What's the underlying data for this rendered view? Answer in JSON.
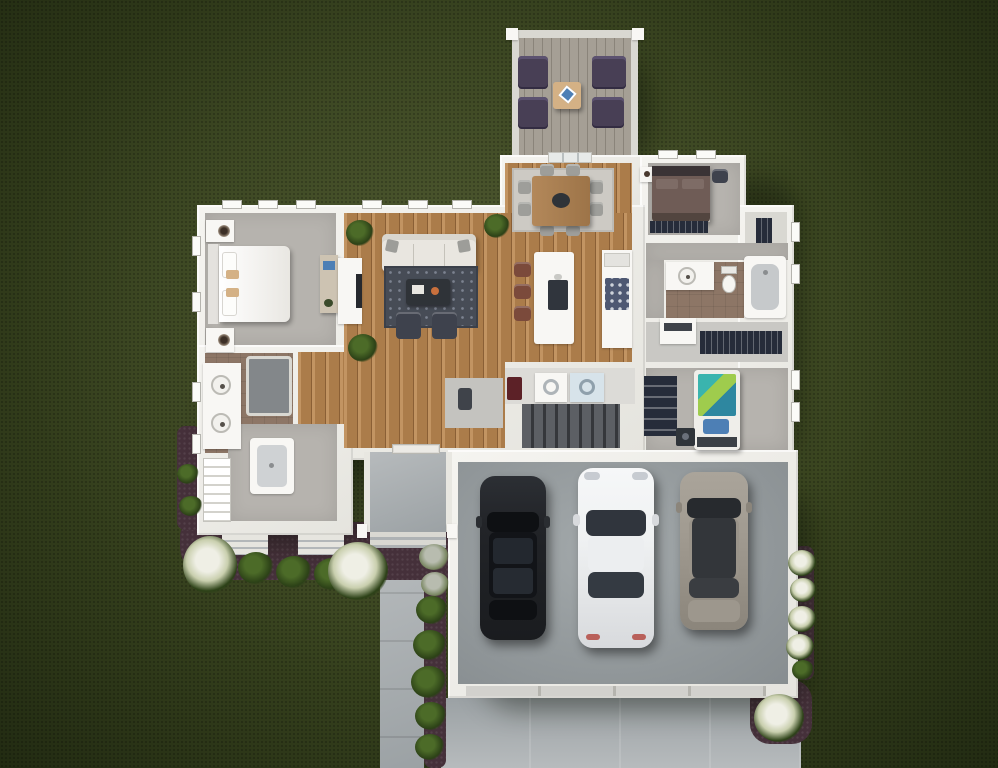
{
  "title": "Aerial 3D floor plan rendering of a single-story home with three-car garage and rear deck",
  "palette": {
    "grassHi": "#4b5629",
    "grassMid": "#39441f",
    "grassLo": "#222b12",
    "mulch": "#45303a",
    "wall": "#f2f1ed",
    "wallShade": "#d9d8d2",
    "wallDk": "#bcbbb5",
    "carpet": "#b6b3ae",
    "carpetDk": "#a5a29d",
    "woodHi": "#c29462",
    "wood": "#ab7c4a",
    "woodLo": "#8a5f35",
    "rugDining": "#cdcac4",
    "rugLiving": "#474c56",
    "rugDot": "#7c8290",
    "tile": "#8d7666",
    "concrete": "#b7bbbd",
    "concreteDk": "#9ba1a4",
    "garageHi": "#a3a9ab",
    "garageLo": "#878d90",
    "deckWood": "#a59f95",
    "deckGap": "#8a847a",
    "stairTread": "#5c5f64",
    "stairGap": "#35373b",
    "navy": "#262c3a",
    "sofa": "#e9e6e0",
    "pillowGray": "#9d9d99",
    "white": "#f8f7f4",
    "tan": "#d4b185",
    "chairDk": "#3e424d",
    "purple": "#483f55",
    "purpleHi": "#5c5270",
    "tableWood": "#b3885a",
    "tableDk": "#2f3338",
    "chairGray": "#9e9e9a",
    "stool": "#7b4a3b",
    "cooktop": "#4e5872",
    "appliance": "#d7e3ea",
    "hamper": "#5c2127",
    "bedBrown": "#6f5c56",
    "bedBrownDk": "#52453f",
    "headboardDk": "#3a3335",
    "teal": "#3ab4ae",
    "lime": "#9fcc4d",
    "tealDk": "#2e87a0",
    "pillowBlue": "#4d7fb5",
    "carDk": "#222428",
    "carDkGlass": "#0e1013",
    "carWhite": "#eff1f2",
    "glassDk": "#30353d",
    "carGray": "#a29c92",
    "carGrayRoof": "#33363a",
    "shrub": "#4c6b28",
    "shrubDk": "#2c4117",
    "flower": "#efefe5",
    "bushGray": "#b8bcaf",
    "laundryFloor": "#dcdbd7",
    "mudFloor": "#c9c8c4",
    "powderFloor": "#c4c3bf",
    "darkItem": "#3f434a",
    "orange": "#c9703d"
  },
  "scene": {
    "view": "top-down aerial rendering",
    "exterior": [
      "lawn",
      "mulch-beds",
      "green-shrubs",
      "white-flowering-bushes",
      "gray-bushes",
      "concrete-walkway",
      "driveway",
      "front-porch",
      "front-steps",
      "rear-deck"
    ],
    "rooms": [
      "master-bedroom",
      "master-bathroom",
      "walk-in-closet",
      "living-room",
      "dining-area",
      "kitchen",
      "hallway",
      "entry",
      "powder-room",
      "laundry-room",
      "stairwell",
      "bedroom-2",
      "closet-2",
      "bathroom-2",
      "mudroom-closet",
      "bedroom-3",
      "garage"
    ],
    "furniture": {
      "deck": [
        "four-purple-armchairs",
        "outdoor-table-with-blue-napkin"
      ],
      "master_bedroom": [
        "king-bed-white",
        "two-nightstands-with-lamps",
        "desk-with-blue-laptop"
      ],
      "living_room": [
        "white-sofa",
        "dark-patterned-rug",
        "coffee-table-with-orange-decor",
        "two-dark-armchairs",
        "three-potted-plants",
        "fireplace"
      ],
      "dining_area": [
        "light-rug",
        "wood-table",
        "dark-centerpiece",
        "eight-gray-chairs"
      ],
      "kitchen": [
        "white-island-with-sink",
        "three-brown-barstools",
        "wall-counter-with-cooktop"
      ],
      "laundry_room": [
        "washer",
        "dryer",
        "red-hamper"
      ],
      "master_bathroom": [
        "double-vanity-two-sinks",
        "dark-shower",
        "white-corner-shower",
        "closet-shelving"
      ],
      "bedroom_2": [
        "brown-bed",
        "white-nightstand",
        "dark-chair",
        "navy-closet-strip"
      ],
      "bathroom_2": [
        "vanity-with-sink",
        "toilet",
        "bathtub"
      ],
      "mudroom": [
        "white-bench",
        "navy-hanging-closet"
      ],
      "bedroom_3": [
        "bed-with-teal-duvet-and-blue-pillow",
        "navy-wardrobe",
        "dark-nightstand"
      ]
    },
    "vehicles": [
      {
        "id": "sedan-dark",
        "color": "dark-charcoal"
      },
      {
        "id": "sedan-white",
        "color": "white"
      },
      {
        "id": "suv-gray",
        "color": "warm-gray"
      }
    ]
  }
}
